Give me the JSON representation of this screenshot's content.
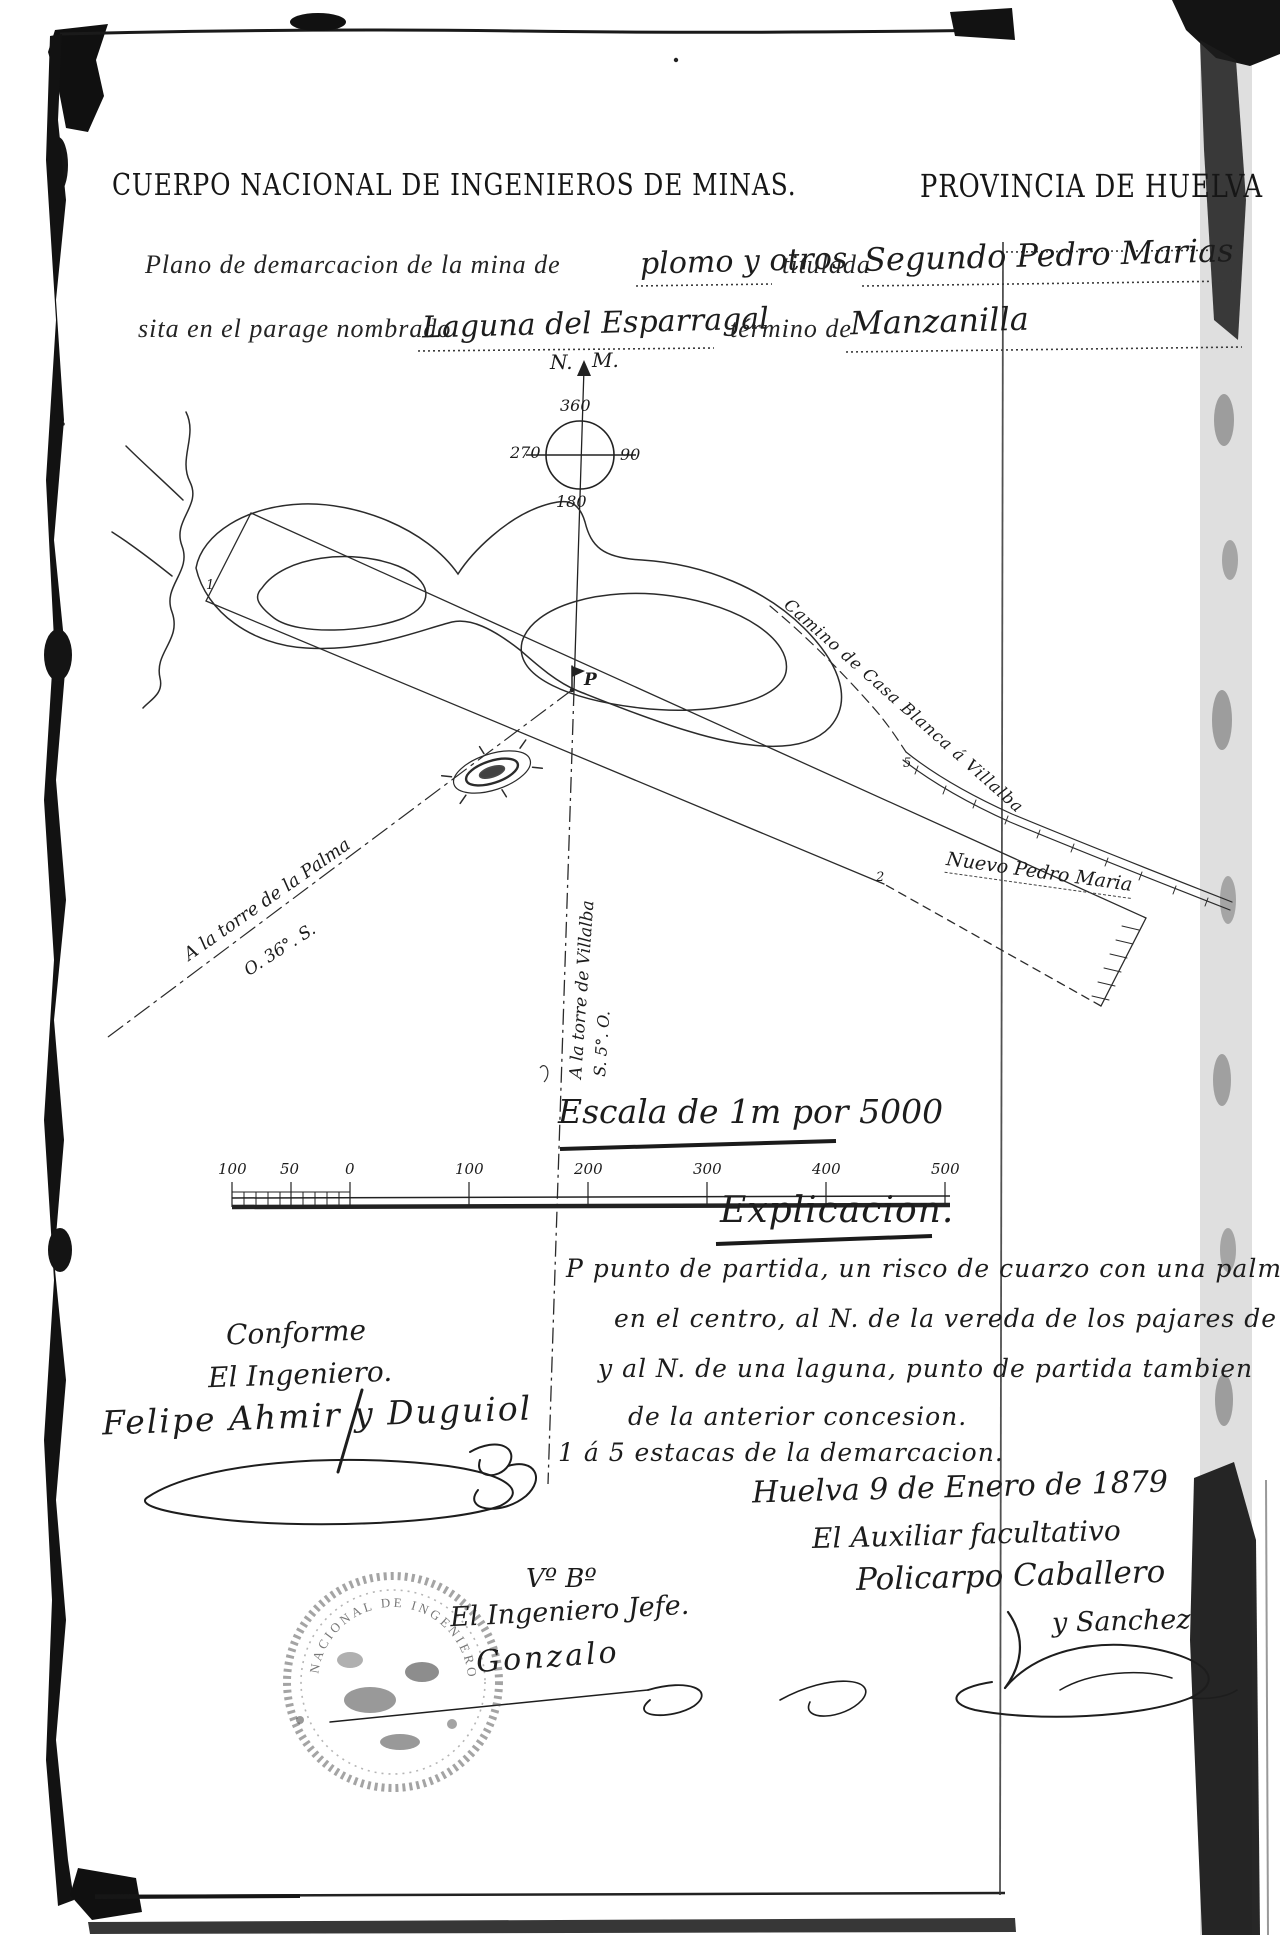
{
  "header": {
    "left": "CUERPO NACIONAL DE INGENIEROS DE MINAS.",
    "right": "PROVINCIA DE HUELVA"
  },
  "form": {
    "line1_printed_a": "Plano de demarcacion de la mina de",
    "line1_written_a": "plomo y otros",
    "line1_printed_b": "titulada",
    "line1_written_b": "Segundo Pedro Marias",
    "line2_printed_a": "sita en el parage nombrado",
    "line2_written_a": "Laguna del Esparragal",
    "line2_printed_b": "término de",
    "line2_written_b": "Manzanilla"
  },
  "compass": {
    "label_n": "N.",
    "label_m": "M.",
    "deg_n": "360",
    "deg_w": "270",
    "deg_e": "90",
    "deg_s": "180"
  },
  "map": {
    "point_label": "P",
    "road_label": "Camino de Casa Blanca á Villalba",
    "mine_label": "Nuevo Pedro Maria",
    "palma_label": "A la torre de la Palma",
    "palma_bearing": "O. 36°. S.",
    "villalba_label": "A la torre de Villalba",
    "villalba_bearing": "S. 5°. O.",
    "stake_1": "1",
    "stake_2": "2",
    "stake_5": "5"
  },
  "scale": {
    "title": "Escala de 1m por 5000",
    "ticks": [
      "100",
      "50",
      "0",
      "100",
      "200",
      "300",
      "400",
      "500"
    ]
  },
  "explanation": {
    "heading": "Explicacion.",
    "lines": [
      "P   punto de partida, un risco de cuarzo con una palmera",
      "en el centro, al N. de la vereda de los pajares de Villalba",
      "y al N. de una laguna, punto de partida tambien",
      "de la anterior concesion.",
      "1 á 5 estacas de la demarcacion."
    ]
  },
  "signatures": {
    "right": {
      "dateline": "Huelva 9 de Enero de 1879",
      "role": "El Auxiliar facultativo",
      "name1": "Policarpo Caballero",
      "name2": "y Sanchez"
    },
    "left": {
      "conforme": "Conforme",
      "role": "El Ingeniero.",
      "name": "Felipe Ahmir y Duguiol"
    },
    "visto_bueno": {
      "vb": "Vº Bº",
      "role": "El Ingeniero Jefe.",
      "name": "Gonzalo"
    }
  },
  "stamp": {
    "rim_text": "NACIONAL  DE  INGENIEROS"
  },
  "colors": {
    "ink": "#1d1d1d",
    "paper": "#ffffff"
  }
}
